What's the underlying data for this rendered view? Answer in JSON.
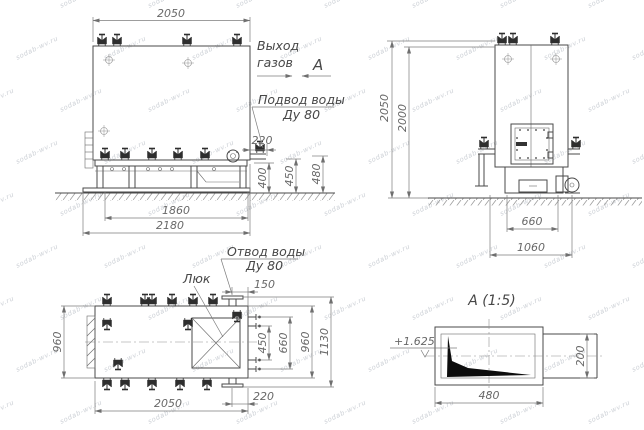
{
  "watermark": {
    "text": "sodab-wv.ru"
  },
  "labels": {
    "gas1": "Выход",
    "gas2": "газов",
    "view": "А",
    "supply1": "Подвод воды",
    "supply2": "Ду 80",
    "return1": "Отвод воды",
    "return2": "Ду 80",
    "hatch": "Люк",
    "detail_title": "А  (1:5)",
    "elevation": "+1.625"
  },
  "dims": {
    "front": {
      "top": "2050",
      "frame_inner": "1860",
      "frame_outer": "2180",
      "supply_offset": "220",
      "h400": "400",
      "h450": "450",
      "h480": "480"
    },
    "side": {
      "h_outer": "2050",
      "h_inner": "2000",
      "base_inner": "660",
      "base_outer": "1060"
    },
    "plan": {
      "width": "960",
      "length": "2050",
      "outlet_offset_top": "150",
      "outlet_offset_bottom": "220",
      "right1": "450",
      "right2": "660",
      "right3": "960",
      "right4": "1130"
    },
    "detail": {
      "width": "480",
      "height": "200"
    }
  }
}
